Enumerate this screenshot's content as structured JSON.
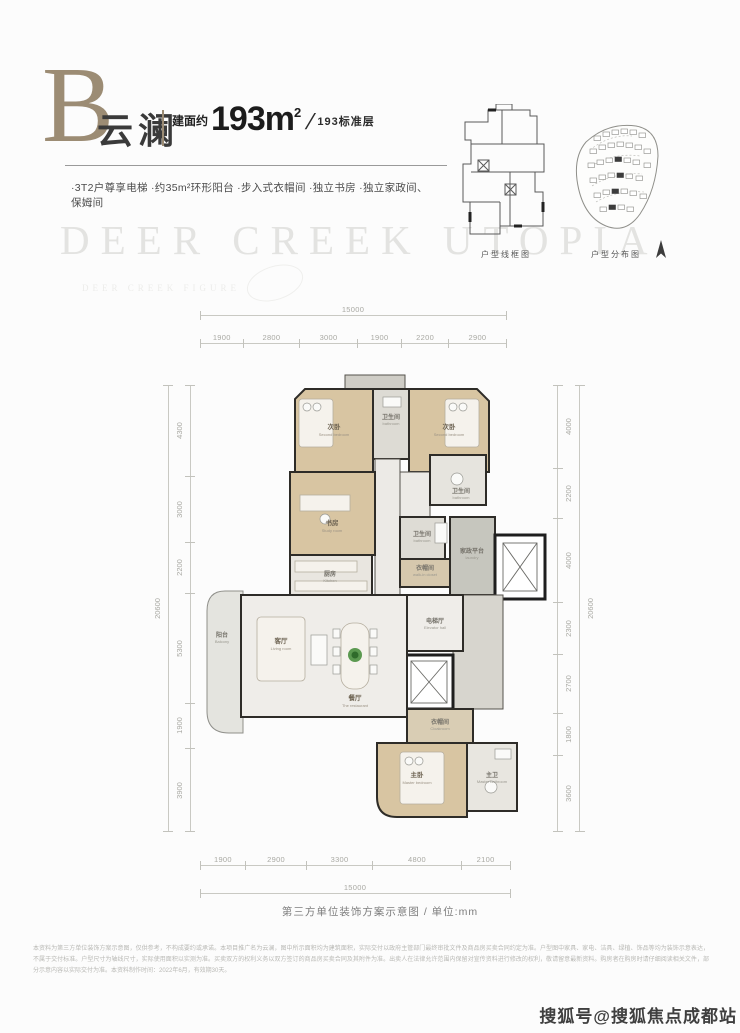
{
  "colors": {
    "accent_gold": "#9c8c74",
    "wall": "#2e2c28",
    "wood_floor": "#d8c5a2",
    "dim_text": "#a9a9a3",
    "watermark": "#e3e3e1"
  },
  "header": {
    "plan_letter": "B",
    "plan_name": "云澜",
    "area_prefix": "建面约",
    "area_value": "193m",
    "area_sup": "2",
    "area_slash": "/",
    "area_suffix": "193标准层",
    "features": "·3T2户尊享电梯 ·约35m²环形阳台 ·步入式衣帽间 ·独立书房 ·独立家政间、保姆间"
  },
  "watermark": {
    "main": "DEER CREEK UTOPIA",
    "sub": "DEER CREEK FIGURE"
  },
  "minimaps": {
    "wireframe_label": "户型线框图",
    "distribution_label": "户型分布图"
  },
  "floorplan": {
    "caption": "第三方单位装饰方案示意图 / 单位:mm",
    "rooms": {
      "second_bedroom_left": {
        "cn": "次卧",
        "en": "Second bedroom"
      },
      "second_bedroom_right": {
        "cn": "次卧",
        "en": "Second bedroom"
      },
      "bathroom_top": {
        "cn": "卫生间",
        "en": "bathroom"
      },
      "bathroom_right": {
        "cn": "卫生间",
        "en": "bathroom"
      },
      "bathroom_mid": {
        "cn": "卫生间",
        "en": "bathroom"
      },
      "study": {
        "cn": "书房",
        "en": "Study room"
      },
      "walk_in_closet": {
        "cn": "衣帽间",
        "en": "walk-in closet"
      },
      "laundry": {
        "cn": "家政平台",
        "en": "laundry"
      },
      "elevator_hall": {
        "cn": "电梯厅",
        "en": "Elevator hall"
      },
      "kitchen": {
        "cn": "厨房",
        "en": "Kitchen"
      },
      "living": {
        "cn": "客厅",
        "en": "Living room"
      },
      "dining": {
        "cn": "餐厅",
        "en": "The restaurant"
      },
      "balcony": {
        "cn": "阳台",
        "en": "Balcony"
      },
      "cloakroom": {
        "cn": "衣帽间",
        "en": "Cloakroom"
      },
      "master_bedroom": {
        "cn": "主卧",
        "en": "Master bedroom"
      },
      "master_bathroom": {
        "cn": "主卫",
        "en": "Master bathroom"
      }
    }
  },
  "dimensions": {
    "top": {
      "total": "15000",
      "segments": [
        "1900",
        "2800",
        "3000",
        "1900",
        "2200",
        "2900"
      ]
    },
    "bottom": {
      "total": "15000",
      "segments": [
        "1900",
        "2900",
        "3300",
        "4800",
        "2100"
      ]
    },
    "left": {
      "total": "20600",
      "segments": [
        "4300",
        "3000",
        "2200",
        "5300",
        "1900",
        "3900"
      ]
    },
    "right": {
      "total": "20600",
      "segments": [
        "4000",
        "2200",
        "4000",
        "2300",
        "2700",
        "1800",
        "3600"
      ]
    }
  },
  "disclaimer": "本资料为第三方单位装饰方案示意图，仅供参考，不构成要约或承诺。本项目推广名为云澜，图中所示面积均为建筑面积，实际交付以政府主管部门最终审批文件及商品房买卖合同约定为准。户型图中家具、家电、洁具、绿植、饰品等均为装饰示意表达，不属于交付标准。户型尺寸为轴线尺寸，实际使用面积以实测为准。买卖双方的权利义务以双方签订的商品房买卖合同及其附件为准。出卖人在法律允许范围内保留对宣传资料进行修改的权利，敬请留意最新资料。购房者在购房时请仔细阅读相关文件，部分示意内容以实际交付为准。本资料制作时间：2022年6月，有效期30天。",
  "branding": "搜狐号@搜狐焦点成都站"
}
